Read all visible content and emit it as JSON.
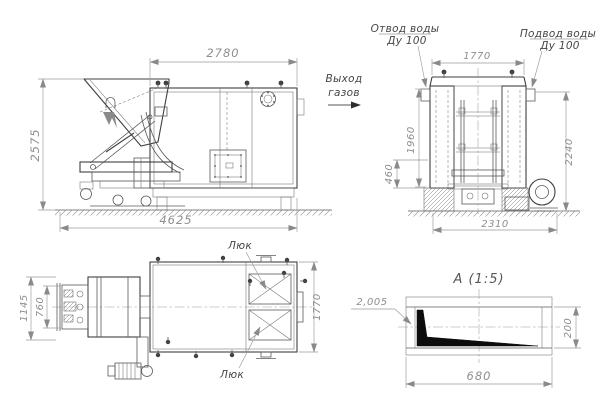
{
  "meta": {
    "bg": "#ffffff",
    "ink_color": "#3f3f3f",
    "dim_line_color": "#9a9a9a",
    "dim_text_color": "#8e8e8e",
    "label_color": "#4f4f4f",
    "wedge_fill": "#0d0d0d"
  },
  "side_view": {
    "dim_width_top": "2780",
    "dim_height_left": "2575",
    "dim_width_bottom": "4625",
    "gas_label_line1": "Выход",
    "gas_label_line2": "газов"
  },
  "front_view": {
    "label_outlet_line1": "Отвод воды",
    "label_outlet_line2": "Ду 100",
    "label_inlet_line1": "Подвод воды",
    "label_inlet_line2": "Ду 100",
    "dim_width_top": "1770",
    "dim_height_mid": "1960",
    "dim_height_base": "460",
    "dim_height_right": "2240",
    "dim_width_bottom": "2310"
  },
  "plan_view": {
    "label_hatch_top": "Люк",
    "label_hatch_bottom": "Люк",
    "dim_height_outer": "1145",
    "dim_height_inner": "760",
    "dim_height_right": "1770"
  },
  "detail_view": {
    "title": "А  (1:5)",
    "dim_leader": "2,005",
    "dim_height": "200",
    "dim_width": "680"
  }
}
